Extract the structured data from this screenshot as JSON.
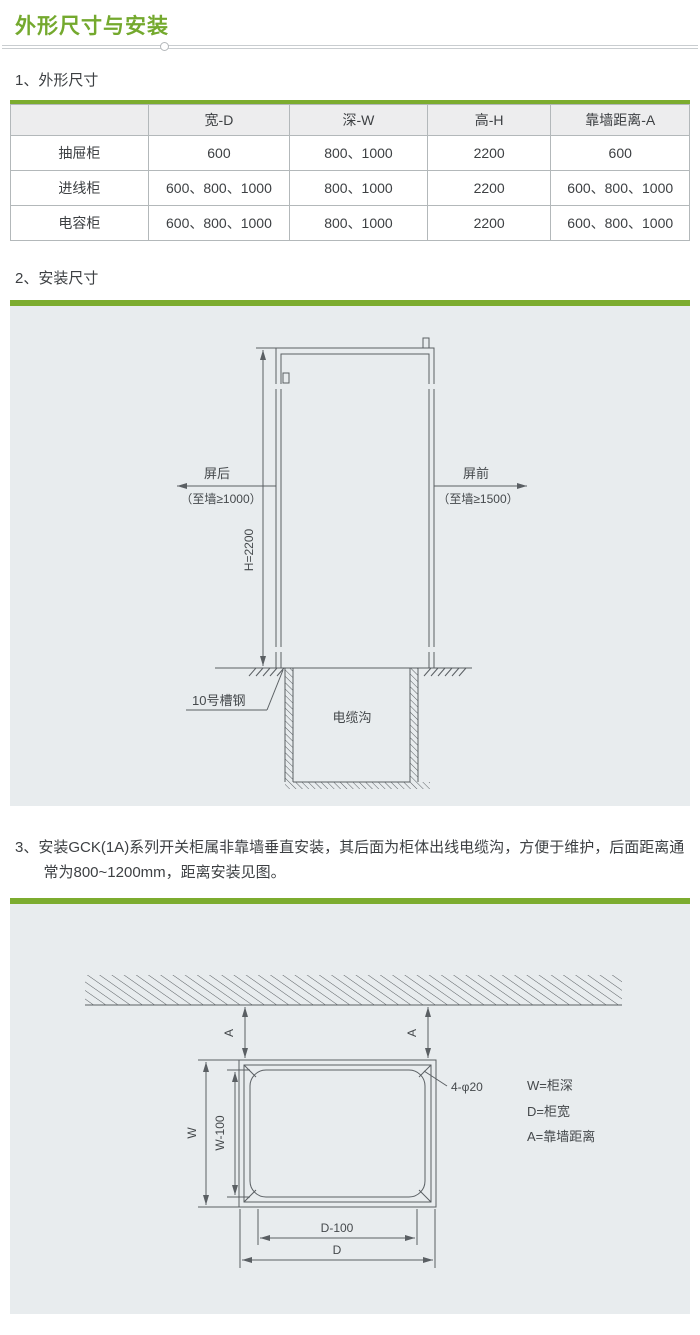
{
  "title": "外形尺寸与安装",
  "sections": {
    "s1": {
      "heading": "1、外形尺寸"
    },
    "s2": {
      "heading": "2、安装尺寸"
    },
    "s3": {
      "text": "3、安装GCK(1A)系列开关柜属非靠墙垂直安装，其后面为柜体出线电缆沟，方便于维护，后面距离通常为800~1200mm，距离安装见图。"
    }
  },
  "table": {
    "headers": [
      "",
      "宽-D",
      "深-W",
      "高-H",
      "靠墙距离-A"
    ],
    "rows": [
      [
        "抽屉柜",
        "600",
        "800、1000",
        "2200",
        "600"
      ],
      [
        "进线柜",
        "600、800、1000",
        "800、1000",
        "2200",
        "600、800、1000"
      ],
      [
        "电容柜",
        "600、800、1000",
        "800、1000",
        "2200",
        "600、800、1000"
      ]
    ]
  },
  "diagram1": {
    "height_dim": "H=2200",
    "rear_label": "屏后",
    "rear_note": "（至墙≥1000）",
    "front_label": "屏前",
    "front_note": "（至墙≥1500）",
    "channel_steel_label": "10号槽钢",
    "cable_trench_label": "电缆沟"
  },
  "diagram2": {
    "wall_dist_left": "A",
    "wall_dist_right": "A",
    "depth_dim": "W",
    "depth_inner_dim": "W-100",
    "width_inner_dim": "D-100",
    "width_dim": "D",
    "holes_label": "4-φ20",
    "legend": [
      "W=柜深",
      "D=柜宽",
      "A=靠墙距离"
    ]
  },
  "colors": {
    "accent_green": "#7CAC2F",
    "title_green": "#74A92E",
    "panel_bg": "#E8ECEE",
    "line_gray": "#5A5F63"
  }
}
